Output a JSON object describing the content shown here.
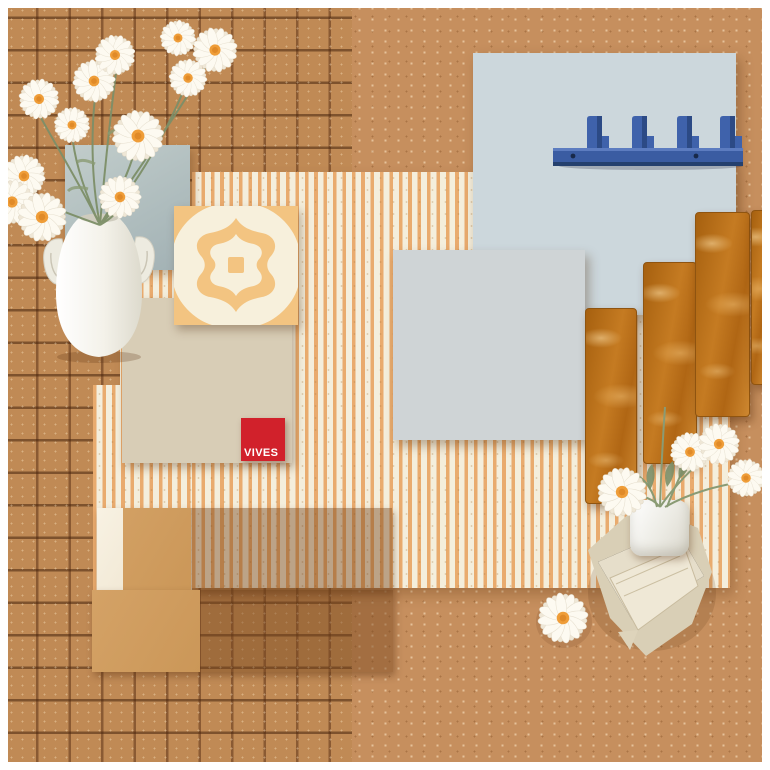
{
  "canvas": {
    "width": 770,
    "height": 770,
    "frame_color": "#ffffff"
  },
  "brand": {
    "logo_text": "VIVES",
    "logo_bg": "#d1212b",
    "logo_text_color": "#ffffff"
  },
  "palette": {
    "clay_background": "#c68f5e",
    "mosaic_tile": "#c08a55",
    "mosaic_grout": "#8a5a33",
    "stripe_cream": "#f4eedc",
    "stripe_orange": "#e9ab6e",
    "blue_tile": "#92a7b9",
    "blue_grout": "#ccd7dc",
    "hook_blue": "#3c5fa4",
    "checker_orange": "#f2b366",
    "checker_grey": "#a8b2bc",
    "plank_caramel": "#b56f1d",
    "tan_tile": "#cf9c5f",
    "cream_tile": "#f6efdf",
    "dot_color": "#cd9857",
    "arabesque_orange": "#f3c481",
    "logo_red": "#d1212b",
    "ceramic_white": "#f4f2ea",
    "napkin_linen": "#e3dac2",
    "greenery": "#7d8f68",
    "daisy_center": "#ef9d38"
  },
  "scene": {
    "description_not_rendered": "tile moodboard flat lay",
    "hook_count": 4,
    "objects": [
      "terracotta-mosaic-backdrop",
      "speckled-clay-backdrop",
      "fluted-stripe-tile-panel",
      "glossy-blue-subway-tile-panel",
      "blue-wall-hook-rack",
      "orange-grey-checkerboard-tile-panel",
      "glossy-caramel-plank-tiles",
      "camel-square-tile-rows-with-white-accents",
      "polka-dot-tile-panel",
      "arabesque-pattern-tile",
      "vives-logo-tile",
      "pale-blue-square-tile",
      "white-vase-with-ear-handles",
      "daisy-bouquet",
      "white-cup-with-daisies",
      "folded-linen-napkin",
      "single-daisy"
    ]
  }
}
